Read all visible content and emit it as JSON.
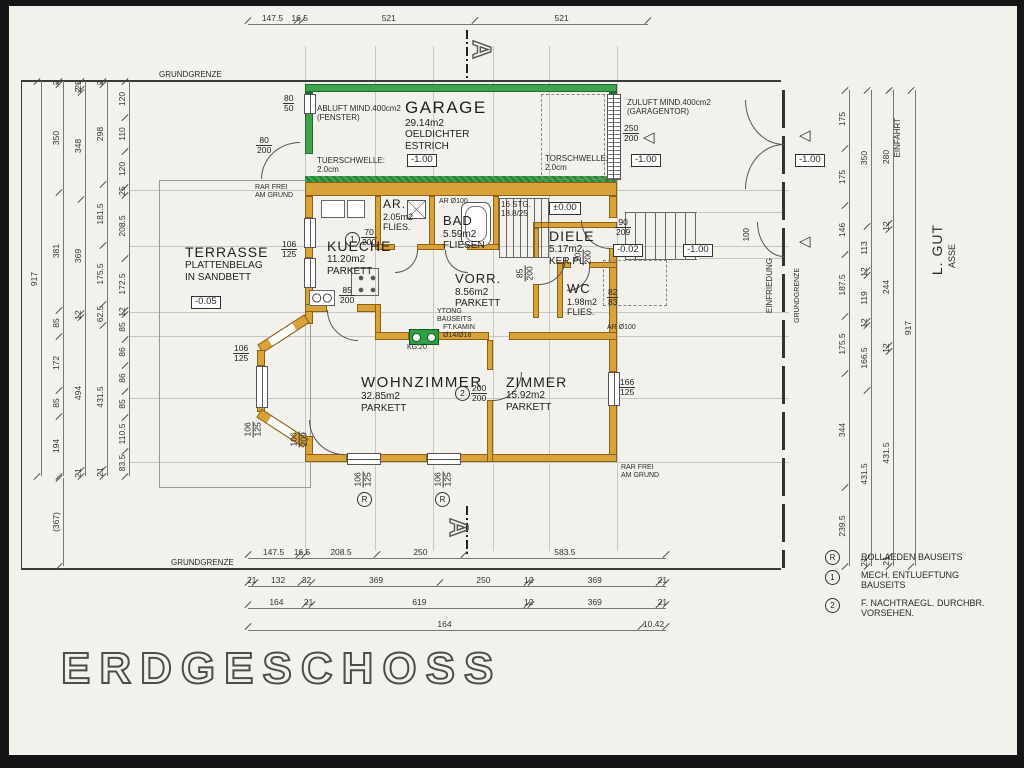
{
  "title": "ERDGESCHOSS",
  "site": {
    "grundgrenze": "GRUNDGRENZE",
    "einfriedung": "EINFRIEDUNG",
    "einfahrt": "EINFAHRT",
    "street1": "L. GUT",
    "street2": "ASSE",
    "gate_dim": "100"
  },
  "section": {
    "label": "A"
  },
  "icons": {
    "entrance_arrow": "◁"
  },
  "garage": {
    "name": "GARAGE",
    "area": "29.14m2",
    "mat1": "OELDICHTER",
    "mat2": "ESTRICH",
    "level": "-1.00",
    "abluft1": "ABLUFT MIND.400cm2",
    "abluft2": "(FENSTER)",
    "zuluft1": "ZULUFT MIND.400cm2",
    "zuluft2": "(GARAGENTOR)",
    "tor1": "TORSCHWELLE:",
    "tor2": "2.0cm",
    "tuer1": "TUERSCHWELLE:",
    "tuer2": "2.0cm",
    "door": "250/200",
    "window": "80/50",
    "side_door": "80/200"
  },
  "rooms": {
    "terrasse": {
      "name": "TERRASSE",
      "l1": "PLATTENBELAG",
      "l2": "IN SANDBETT",
      "level": "-0.05"
    },
    "kueche": {
      "name": "KUECHE",
      "area": "11.20m2",
      "floor": "PARKETT"
    },
    "ar": {
      "name": "AR.",
      "area": "2.05m2",
      "floor": "FLIES."
    },
    "bad": {
      "name": "BAD",
      "area": "5.59m2",
      "floor": "FLIESEN"
    },
    "diele": {
      "name": "DIELE",
      "area": "5.17m2",
      "floor": "KER.PL."
    },
    "vorr": {
      "name": "VORR.",
      "area": "8.56m2",
      "floor": "PARKETT"
    },
    "wc": {
      "name": "WC",
      "area": "1.98m2",
      "floor": "FLIES."
    },
    "wohnzimmer": {
      "name": "WOHNZIMMER",
      "area": "32.85m2",
      "floor": "PARKETT"
    },
    "zimmer": {
      "name": "ZIMMER",
      "area": "15.92m2",
      "floor": "PARKETT"
    }
  },
  "stairs": {
    "l1": "16 STG.",
    "l2": "18.8/25",
    "level": "±0.00"
  },
  "levels": {
    "entry": "-0.02",
    "stair": "-1.00",
    "drive": "-1.00",
    "site_right": "-1.00"
  },
  "notes": {
    "rar1": "RAR FREI",
    "rar2": "AM GRUND",
    "ytong1": "YTONG",
    "ytong2": "BAUSEITS",
    "kamin1": "FT.KAMIN",
    "kamin2": "Ø14/Ø18",
    "kamin3": "KG:20",
    "ar100": "AR Ø100"
  },
  "openings": {
    "entry_door": "90/209",
    "wc_win": "82/83",
    "kueche_door": "85/200",
    "diele_door": "85/200",
    "ar_door": "70/200",
    "wc_door": "70/200",
    "win": "106/125",
    "terr_door": "106/209",
    "zimmer_win": "166/125",
    "zimmer_opening": "200/200"
  },
  "legend": {
    "sym_r": "R",
    "r1": "ROLLAEDEN BAUSEITS",
    "sym_1": "1",
    "m1": "MECH. ENTLUEFTUNG",
    "m2": "BAUSEITS",
    "sym_2": "2",
    "n1": "F. NACHTRAEGL. DURCHBR.",
    "n2": "VORSEHEN."
  },
  "dims": {
    "top": [
      "147.5",
      "16.5",
      "521",
      "521"
    ],
    "bottom1": [
      "147.5",
      "16.5",
      "208.5",
      "250",
      "583.5"
    ],
    "bottom2": [
      "21",
      "132",
      "32",
      "369",
      "250",
      "12",
      "369",
      "21"
    ],
    "bottom3": [
      "164",
      "21",
      "619",
      "12",
      "369",
      "21"
    ],
    "bottom4": [
      "164",
      "10.42"
    ],
    "left1": [
      "917"
    ],
    "left2": [
      "2",
      "350",
      "381",
      "85",
      "172",
      "85",
      "194"
    ],
    "left3": [
      "25",
      "2",
      "348",
      "369",
      "12",
      "494",
      "21"
    ],
    "left4": [
      "2",
      "298",
      "181.5",
      "175.5",
      "62.5",
      "431.5",
      "21"
    ],
    "left5": [
      "120",
      "110",
      "120",
      "25",
      "208.5",
      "172.5",
      "12",
      "85",
      "86",
      "86",
      "85",
      "110.5",
      "83.5"
    ],
    "left6": [
      "(367)"
    ],
    "right1": [
      "175",
      "175",
      "146",
      "187.5",
      "175.5",
      "344",
      "239.5"
    ],
    "right2": [
      "350",
      "113",
      "12",
      "119",
      "12",
      "166.5",
      "431.5",
      "21"
    ],
    "right3": [
      "280",
      "12",
      "244",
      "12",
      "431.5",
      "21"
    ],
    "right4": [
      "917"
    ]
  }
}
